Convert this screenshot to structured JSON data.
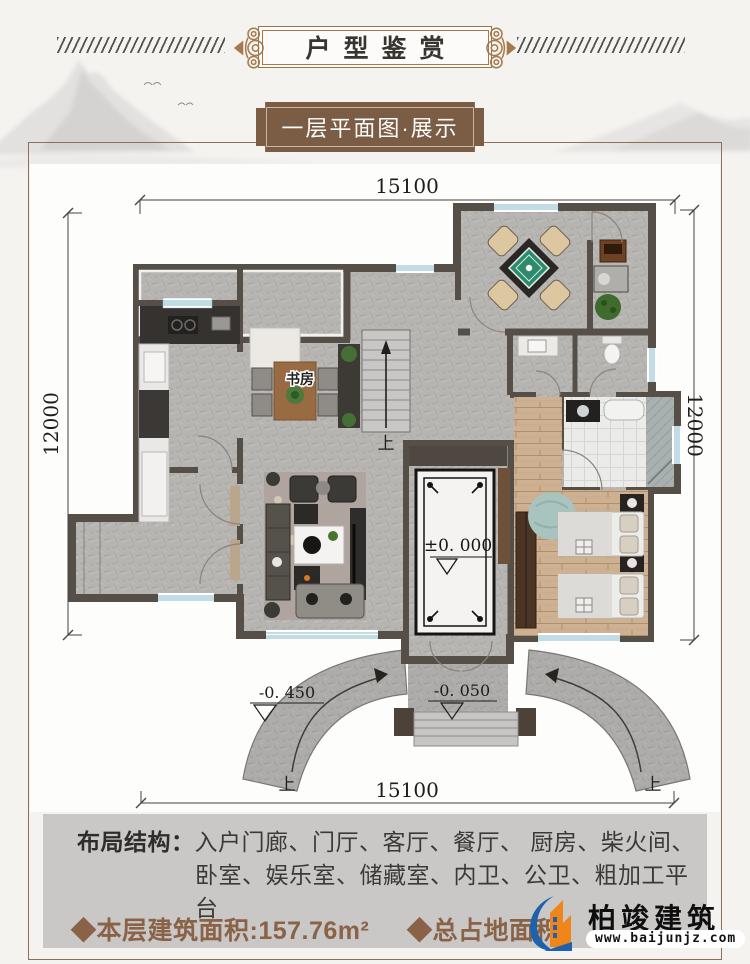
{
  "header": {
    "title": "户型鉴赏"
  },
  "banner": {
    "label": "一层平面图·展示"
  },
  "plan": {
    "dims": {
      "top": "15100",
      "bottom": "15100",
      "left": "12000",
      "right": "12000"
    },
    "labels": {
      "study": "书房",
      "stairs_up": "上",
      "ramp_up_left": "上",
      "ramp_up_right": "上"
    },
    "levels": {
      "zero": "±0. 000",
      "entry": "-0. 050",
      "ramp": "-0. 450"
    }
  },
  "layout_box": {
    "heading": "布局结构：",
    "line1": "入户门廊、门厅、客厅、餐厅、 厨房、柴火间、",
    "line2": "卧室、娱乐室、储藏室、内卫、公卫、粗加工平台"
  },
  "stats": {
    "left": "◆本层建筑面积:157.76m²",
    "right": "◆总占地面积"
  },
  "logo": {
    "name": "柏竣建筑",
    "website": "www.baijunjz.com"
  },
  "colors": {
    "accent_brown": "#8a6247",
    "banner_brown": "#7b5c45",
    "frame_bronze": "#8d7052",
    "logo_blue": "#1e62ab",
    "logo_orange": "#f08519",
    "wall": "#564f48",
    "window_blue": "#86b9cc"
  }
}
